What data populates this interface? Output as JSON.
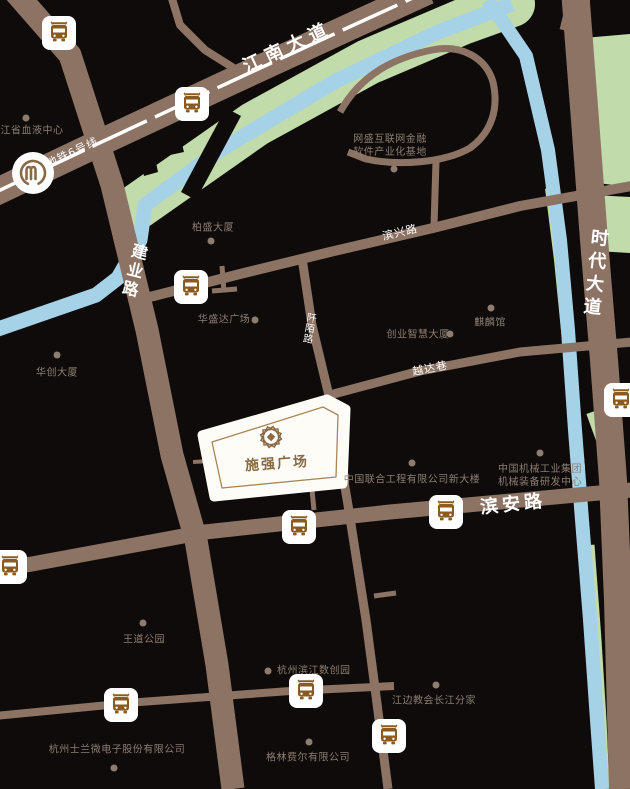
{
  "map_type": "location-map",
  "plot": {
    "name": "施强广场",
    "logo": "shiqiang-emblem"
  },
  "roads": [
    {
      "id": "jiangnan-avenue",
      "label": "江南大道"
    },
    {
      "id": "jianye-road",
      "label": "建业路"
    },
    {
      "id": "shidai-avenue",
      "label": "时代大道"
    },
    {
      "id": "binxing-road",
      "label": "滨兴路"
    },
    {
      "id": "binan-road",
      "label": "滨安路"
    },
    {
      "id": "yueda-lane",
      "label": "越达巷"
    },
    {
      "id": "qianmo-road",
      "label": "阡陌路"
    }
  ],
  "transit": {
    "metro_line": "地铁6号线",
    "metro_icon": "hangzhou-metro-logo",
    "bus_stop_icon": "bus-stop",
    "bus_stop_count": 10
  },
  "pois": [
    {
      "label": "浙江省血液中心"
    },
    {
      "lines": [
        "网盛互联网金融",
        "软件产业化基地"
      ]
    },
    {
      "label": "柏盛大厦"
    },
    {
      "label": "华盛达广场"
    },
    {
      "label": "华创大厦"
    },
    {
      "label": "麒麟馆"
    },
    {
      "label": "创业智慧大厦"
    },
    {
      "label": "中国联合工程有限公司新大楼"
    },
    {
      "lines": [
        "中国机械工业集团",
        "机械装备研发中心"
      ]
    },
    {
      "label": "王道公园"
    },
    {
      "label": "杭州滨江数创园"
    },
    {
      "label": "江边教会长江分家"
    },
    {
      "label": "杭州士兰微电子股份有限公司"
    },
    {
      "label": "格林费尔有限公司"
    }
  ],
  "colors": {
    "background": "#0e0b0a",
    "road": "#8d7363",
    "river": "#a6d2e7",
    "park_green": "#c1dbaa",
    "poi_text": "#8d7d71",
    "road_text": "#ffffff",
    "brand_gold": "#8a6a45",
    "bus_glyph": "#8a5a1e",
    "plot_fill": "#fdfcf7"
  }
}
